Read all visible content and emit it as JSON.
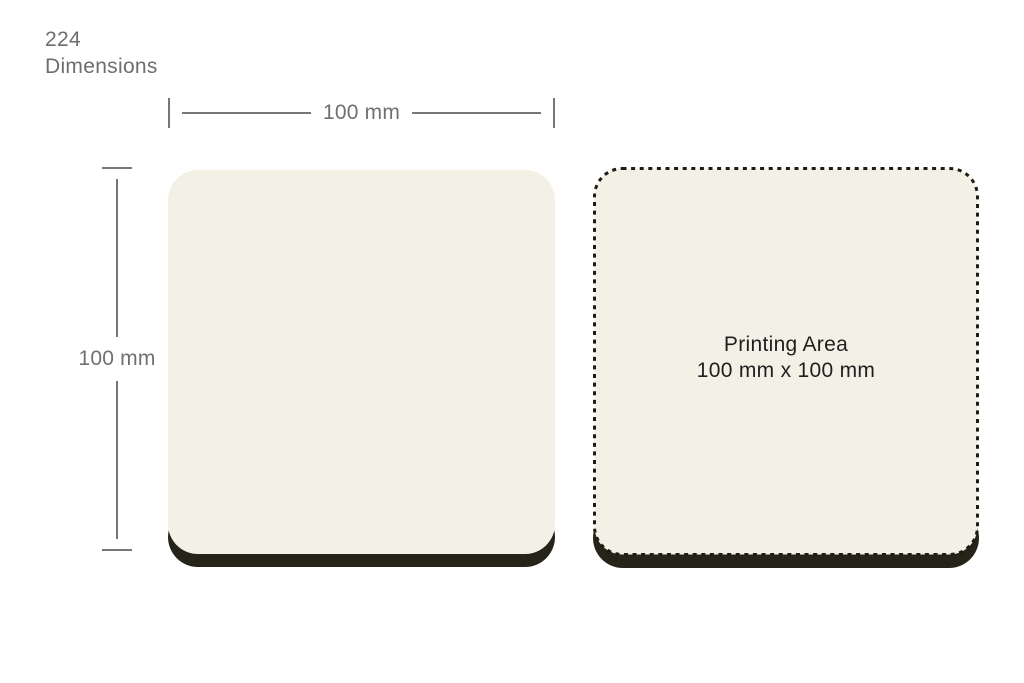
{
  "header": {
    "product_code": "224",
    "section_label": "Dimensions"
  },
  "annotations": {
    "width_label": "100 mm",
    "height_label": "100 mm"
  },
  "printing_area": {
    "title": "Printing Area",
    "size": "100 mm x 100 mm"
  },
  "colors": {
    "background": "#ffffff",
    "surface_cream": "#f3f1e5",
    "base_edge_dark": "#262418",
    "dotted_outline": "#1e1d12",
    "dimension_gray": "#76777a",
    "title_gray": "#6d6e71",
    "label_text": "#1f1f1f"
  }
}
